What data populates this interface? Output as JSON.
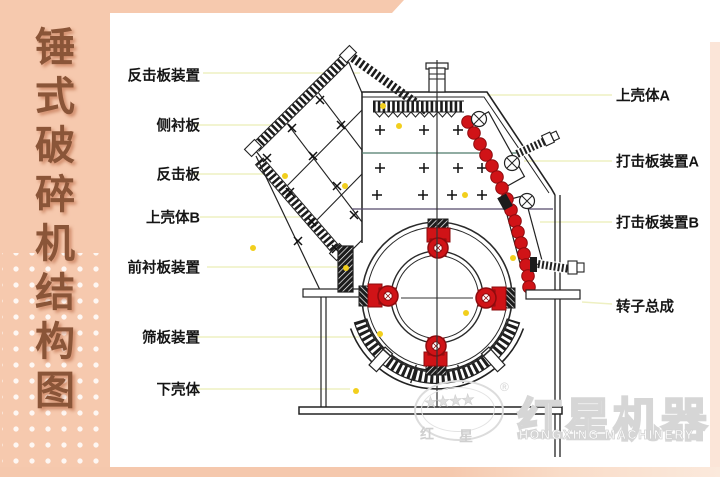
{
  "sidebar": {
    "title": "锤式破碎机结构图"
  },
  "labels": {
    "left": [
      {
        "text": "反击板装置"
      },
      {
        "text": "侧衬板"
      },
      {
        "text": "反击板"
      },
      {
        "text": "上壳体B"
      },
      {
        "text": "前衬板装置"
      },
      {
        "text": "筛板装置"
      },
      {
        "text": "下壳体"
      }
    ],
    "right": [
      {
        "text": "上壳体A"
      },
      {
        "text": "打击板装置A"
      },
      {
        "text": "打击板装置B"
      },
      {
        "text": "转子总成"
      }
    ]
  },
  "watermark": {
    "stars": "★★★★",
    "registered": "®",
    "cn_left": "红",
    "cn_right": "星",
    "brand_cn": "红星机器",
    "brand_en": "HONGXING MACHINERY"
  },
  "colors": {
    "frame_peach": "#f6c9ae",
    "title_brown": "#8a5538",
    "leader_yellow": "#eef0c2",
    "machine_red": "#d01317",
    "marker_yellow": "#f2cf1d",
    "watermark_gray": "#d9d9d9"
  }
}
